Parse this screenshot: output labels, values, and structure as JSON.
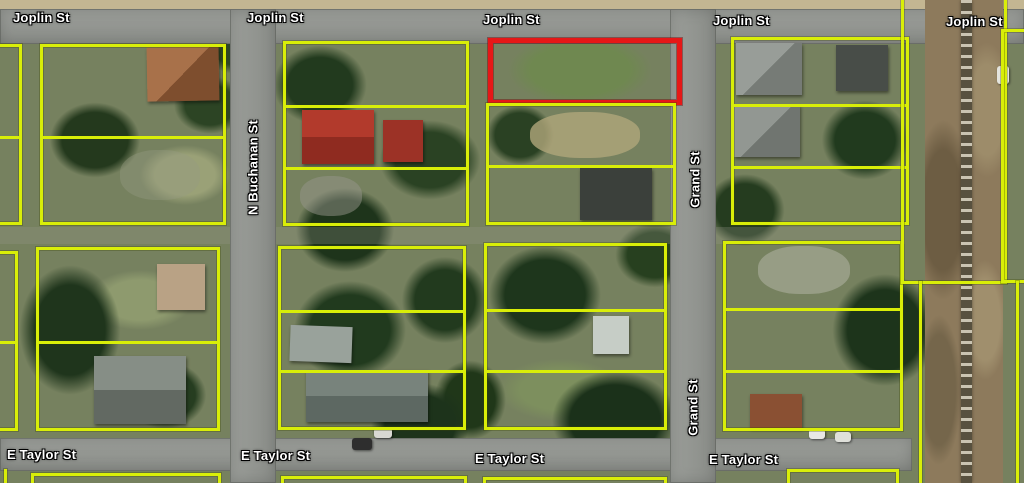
{
  "map": {
    "labels": {
      "joplin_st": "Joplin St",
      "e_taylor_st": "E Taylor St",
      "n_buchanan_st": "N Buchanan St",
      "grand_st": "Grand St"
    },
    "label_instances": {
      "joplin_st": 5,
      "e_taylor_st": 4,
      "n_buchanan_st": 1,
      "grand_st": 2
    },
    "colors": {
      "parcel_outline_yellow": "#d9ee08",
      "highlighted_parcel_red": "#e61717",
      "road_gray": "#949792",
      "railroad_dirt": "#8d7a5c",
      "street_label_text": "#ffffff"
    },
    "features": {
      "highlighted_parcel": "red-outlined vacant lot on south side of Joplin St, west of Grand St",
      "railroad": "north-south railroad corridor along east edge"
    }
  }
}
